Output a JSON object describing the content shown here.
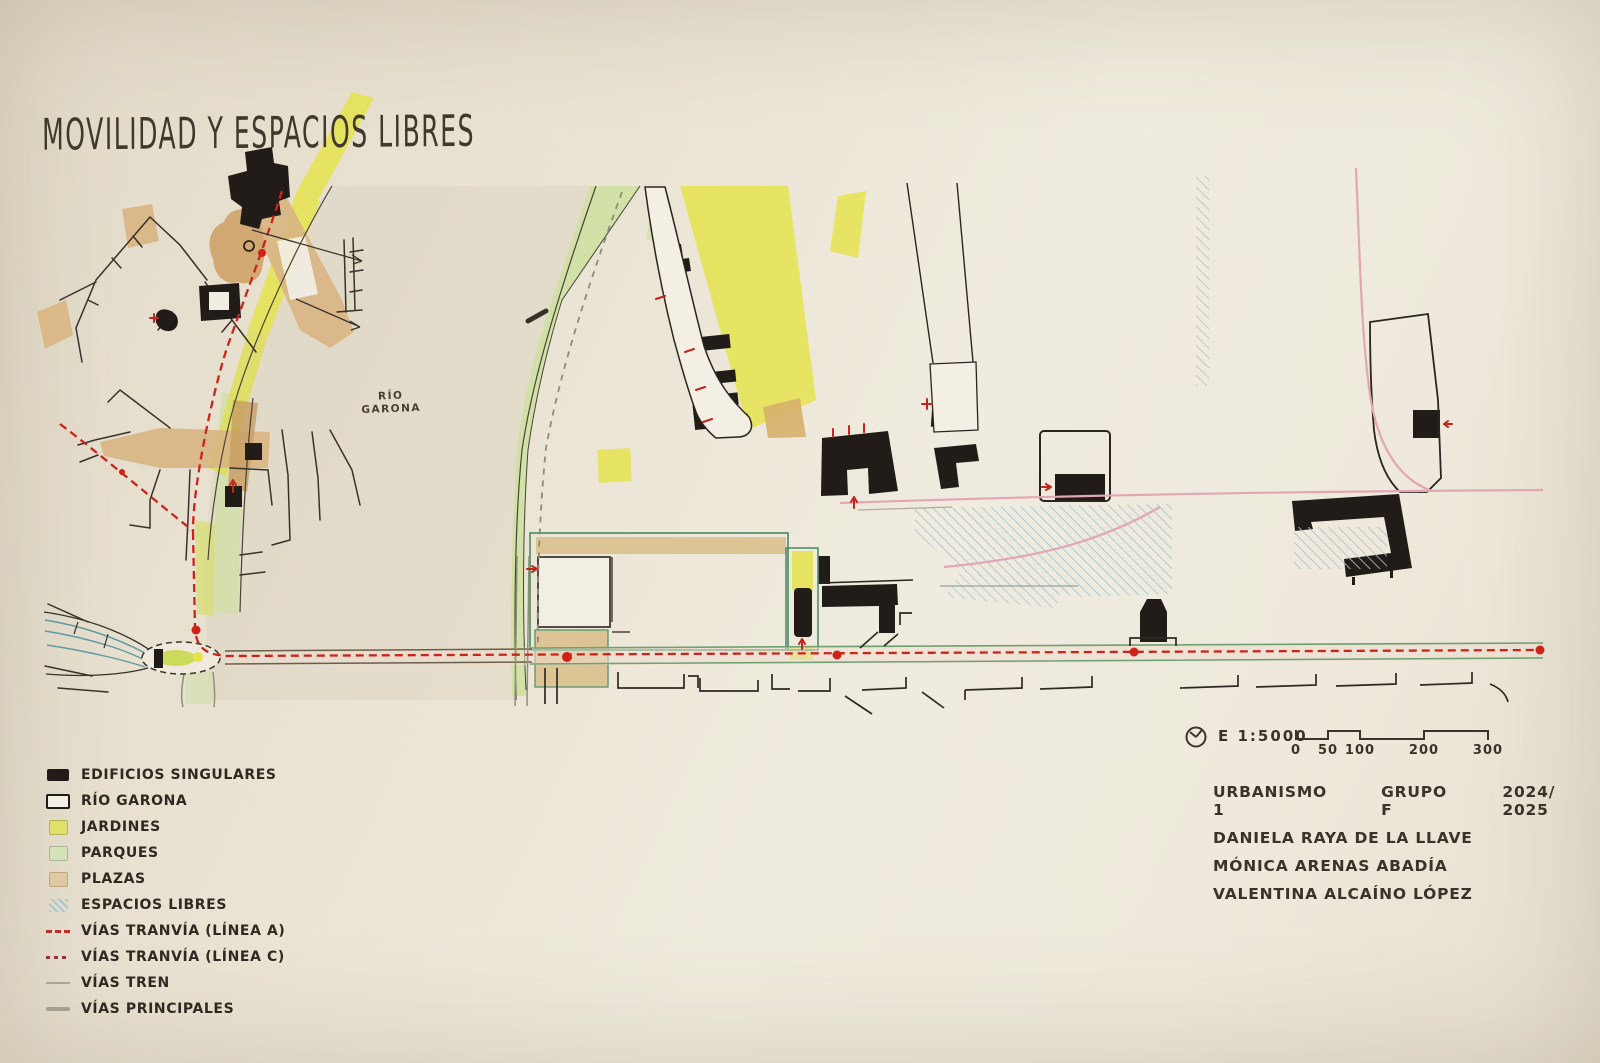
{
  "title": "MOVILIDAD Y ESPACIOS LIBRES",
  "map": {
    "river_label_line1": "RÍO",
    "river_label_line2": "GARONA"
  },
  "legend": {
    "items": [
      {
        "label": "EDIFICIOS SINGULARES",
        "type": "black-rect"
      },
      {
        "label": "RÍO GARONA",
        "type": "white-rect"
      },
      {
        "label": "JARDINES",
        "type": "yellow"
      },
      {
        "label": "PARQUES",
        "type": "green"
      },
      {
        "label": "PLAZAS",
        "type": "tan"
      },
      {
        "label": "ESPACIOS LIBRES",
        "type": "blue-hatch"
      },
      {
        "label": "VÍAS TRANVÍA (LÍNEA A)",
        "type": "dash-red"
      },
      {
        "label": "VÍAS TRANVÍA (LÍNEA C)",
        "type": "dash-maroon"
      },
      {
        "label": "VÍAS TREN",
        "type": "line-thin"
      },
      {
        "label": "VÍAS PRINCIPALES",
        "type": "line-thick"
      }
    ]
  },
  "scale": {
    "label": "E 1:5000",
    "ticks": [
      "0",
      "50",
      "100",
      "200",
      "300"
    ]
  },
  "credits": {
    "course": "URBANISMO 1",
    "group": "GRUPO F",
    "year": "2024/ 2025",
    "authors": [
      "DANIELA RAYA DE LA LLAVE",
      "MÓNICA ARENAS ABADÍA",
      "VALENTINA ALCAÍNO LÓPEZ"
    ]
  },
  "colors": {
    "paper": "#ece6d9",
    "ink": "#26211b",
    "tram_a_red": "#c8251b",
    "tram_c_pink": "#e3a6b5",
    "jardines_yellow": "#e6e34e",
    "parques_green": "#cfe0a3",
    "plazas_tan": "#d9b583",
    "espacios_blue": "#9ec7d2",
    "avenue_green": "#6fa070"
  }
}
